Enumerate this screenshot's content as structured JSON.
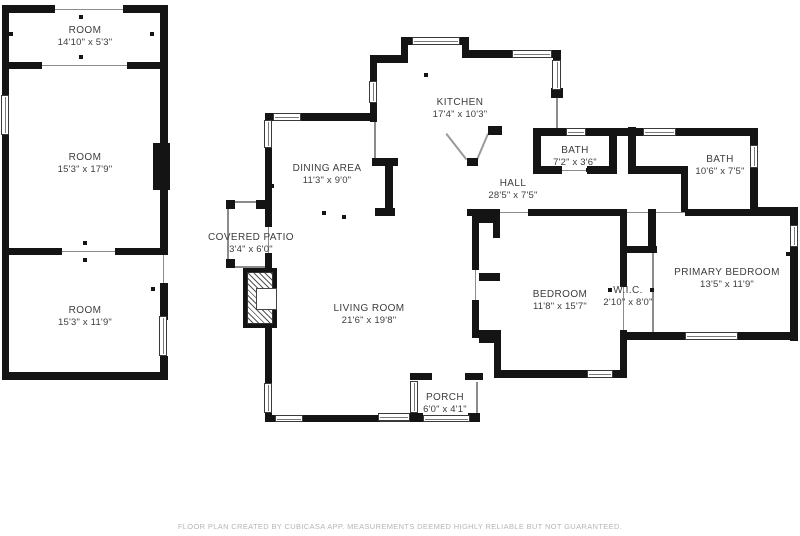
{
  "rooms": [
    {
      "id": "room-top-left",
      "name": "ROOM",
      "dims": "14'10\" x 5'3\""
    },
    {
      "id": "room-middle-left",
      "name": "ROOM",
      "dims": "15'3\" x 17'9\""
    },
    {
      "id": "room-bottom-left",
      "name": "ROOM",
      "dims": "15'3\" x 11'9\""
    },
    {
      "id": "kitchen",
      "name": "KITCHEN",
      "dims": "17'4\" x 10'3\""
    },
    {
      "id": "dining-area",
      "name": "DINING AREA",
      "dims": "11'3\" x 9'0\""
    },
    {
      "id": "bath-small",
      "name": "BATH",
      "dims": "7'2\" x 3'6\""
    },
    {
      "id": "bath-large",
      "name": "BATH",
      "dims": "10'6\" x 7'5\""
    },
    {
      "id": "hall",
      "name": "HALL",
      "dims": "28'5\" x 7'5\""
    },
    {
      "id": "covered-patio",
      "name": "COVERED PATIO",
      "dims": "3'4\" x 6'0\""
    },
    {
      "id": "living-room",
      "name": "LIVING ROOM",
      "dims": "21'6\" x 19'8\""
    },
    {
      "id": "bedroom",
      "name": "BEDROOM",
      "dims": "11'8\" x 15'7\""
    },
    {
      "id": "wic",
      "name": "W.I.C.",
      "dims": "2'10\" x 8'0\""
    },
    {
      "id": "primary-bedroom",
      "name": "PRIMARY BEDROOM",
      "dims": "13'5\" x 11'9\""
    },
    {
      "id": "porch",
      "name": "PORCH",
      "dims": "6'0\" x 4'1\""
    }
  ],
  "disclaimer": "FLOOR PLAN CREATED BY CUBICASA APP. MEASUREMENTS DEEMED HIGHLY RELIABLE BUT NOT GUARANTEED.",
  "colors": {
    "wall": "#141414",
    "background": "#ffffff",
    "label_text": "#3d3d3d",
    "disclaimer_text": "#b6b6b6"
  }
}
